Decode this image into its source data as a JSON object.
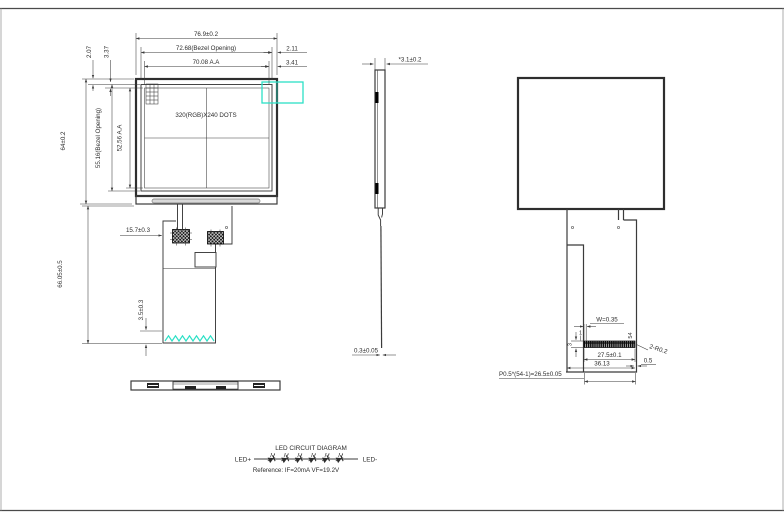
{
  "drawing": {
    "title_note": "",
    "front_view": {
      "label_dots": "320(RGB)X240  DOTS",
      "dims": {
        "width_total": "76.9±0.2",
        "width_bezel": "72.68(Bezel Opening)",
        "width_aa": "70.08 A.A",
        "offset_right_bezel": "2.11",
        "offset_right_aa": "3.41",
        "offset_top_bezel": "2.07",
        "offset_top_aa": "3.37",
        "height_total": "64±0.2",
        "height_bezel": "55.16(Bezel Opening)",
        "height_aa": "52.56 A.A",
        "fpc_length": "66.05±0.5",
        "fpc_offset": "15.7±0.3",
        "fpc_end": "3.5±0.3"
      }
    },
    "side_view": {
      "dims": {
        "thickness": "*3.1±0.2",
        "fpc_thickness": "0.3±0.05"
      }
    },
    "rear_view": {
      "dims": {
        "finger_width": "W=0.35",
        "finger_height": "3",
        "pin_first": "1",
        "pin_last": "54",
        "corner_radius": "2-R0.2",
        "contact_width": "27.5±0.1",
        "tail_width": "36.13",
        "edge_margin": "0.5",
        "pitch_formula": "P0.5*(54-1)=26.5±0.05"
      }
    },
    "led_circuit": {
      "title": "LED CIRCUIT DIAGRAM",
      "anode_label": "LED+",
      "cathode_label": "LED-",
      "reference": "Reference: IF=20mA  VF=19.2V",
      "led_count": 6
    },
    "colors": {
      "line": "#3b3b3b",
      "accent_cyan": "#2ce0c6"
    }
  }
}
